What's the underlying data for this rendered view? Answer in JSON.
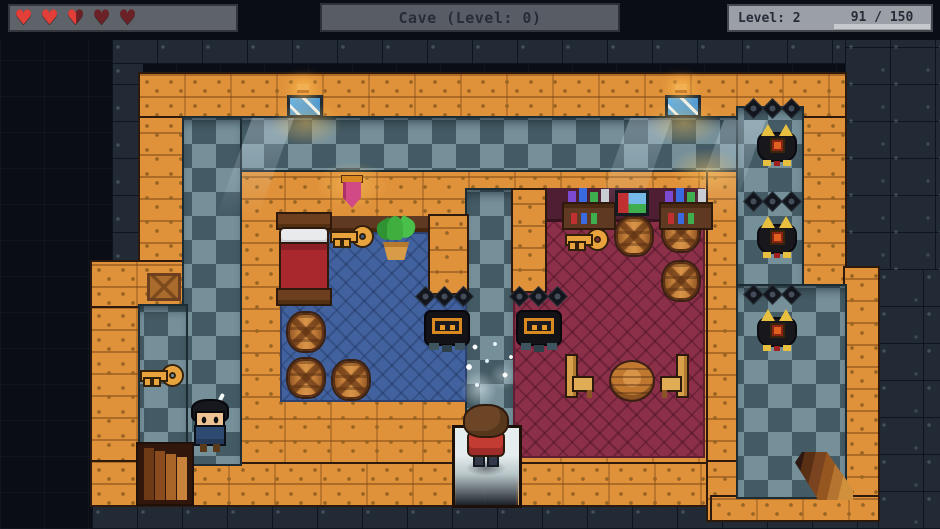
{
  "hud": {
    "hearts": {
      "total": 5,
      "states": [
        "full",
        "full",
        "half",
        "empty",
        "empty"
      ]
    },
    "location_banner": "Cave (Level: 0)",
    "level_panel": {
      "level_label": "Level: 2",
      "xp_text": "91 / 150",
      "xp_current": 91,
      "xp_max": 150,
      "xp_fill_color": "#35d435"
    }
  },
  "scene": {
    "location": "Cave (Level: 0)",
    "colors": {
      "wall": "#e0923a",
      "floor_light": "#76909a",
      "floor_dark": "#3f5761",
      "blue_room": "#41629e",
      "red_room": "#8c3049",
      "background": "#0a0d15"
    },
    "entities": [
      {
        "kind": "window",
        "x": 287,
        "y": 95
      },
      {
        "kind": "window",
        "x": 665,
        "y": 95
      },
      {
        "kind": "lamp",
        "x": 297,
        "y": 84
      },
      {
        "kind": "lamp",
        "x": 675,
        "y": 84
      },
      {
        "kind": "beam",
        "x": 252,
        "y": 118
      },
      {
        "kind": "beam",
        "x": 630,
        "y": 118
      },
      {
        "kind": "beam",
        "x": 724,
        "y": 120
      },
      {
        "kind": "glow",
        "x": 270,
        "y": 100
      },
      {
        "kind": "glow",
        "x": 648,
        "y": 100
      },
      {
        "kind": "glow",
        "x": 316,
        "y": 162
      },
      {
        "kind": "glow",
        "x": 670,
        "y": 148
      },
      {
        "kind": "drow",
        "x": 418,
        "y": 289
      },
      {
        "kind": "drow",
        "x": 512,
        "y": 289
      },
      {
        "kind": "drow",
        "x": 746,
        "y": 101
      },
      {
        "kind": "drow",
        "x": 746,
        "y": 194
      },
      {
        "kind": "drow",
        "x": 746,
        "y": 287
      },
      {
        "kind": "gate",
        "x": 426,
        "y": 312
      },
      {
        "kind": "gate",
        "x": 518,
        "y": 312
      },
      {
        "kind": "bat",
        "x": 759,
        "y": 126
      },
      {
        "kind": "bat",
        "x": 759,
        "y": 218
      },
      {
        "kind": "bat",
        "x": 759,
        "y": 311
      },
      {
        "kind": "key",
        "x": 142,
        "y": 365
      },
      {
        "kind": "key",
        "x": 332,
        "y": 226
      },
      {
        "kind": "key",
        "x": 567,
        "y": 229
      },
      {
        "kind": "barrel",
        "x": 288,
        "y": 313
      },
      {
        "kind": "barrel",
        "x": 288,
        "y": 359
      },
      {
        "kind": "barrel",
        "x": 333,
        "y": 361
      },
      {
        "kind": "barrel",
        "x": 616,
        "y": 217
      },
      {
        "kind": "barrel",
        "x": 663,
        "y": 213
      },
      {
        "kind": "barrel",
        "x": 663,
        "y": 262
      }
    ],
    "props": [
      "bed",
      "potted-plant",
      "pink-banner",
      "wooden-crate",
      "bottle-shelf",
      "bottle-shelf",
      "framed-picture",
      "chair",
      "round-table",
      "chair",
      "staircase-down-left",
      "staircase-down-right",
      "sparkle-dust"
    ],
    "characters": [
      {
        "name": "player-hero",
        "desc": "brown-haired hero in red tunic facing away",
        "x": 463,
        "y": 406
      },
      {
        "name": "npc-villager",
        "desc": "black-haired villager in navy outfit",
        "x": 192,
        "y": 401
      }
    ]
  }
}
